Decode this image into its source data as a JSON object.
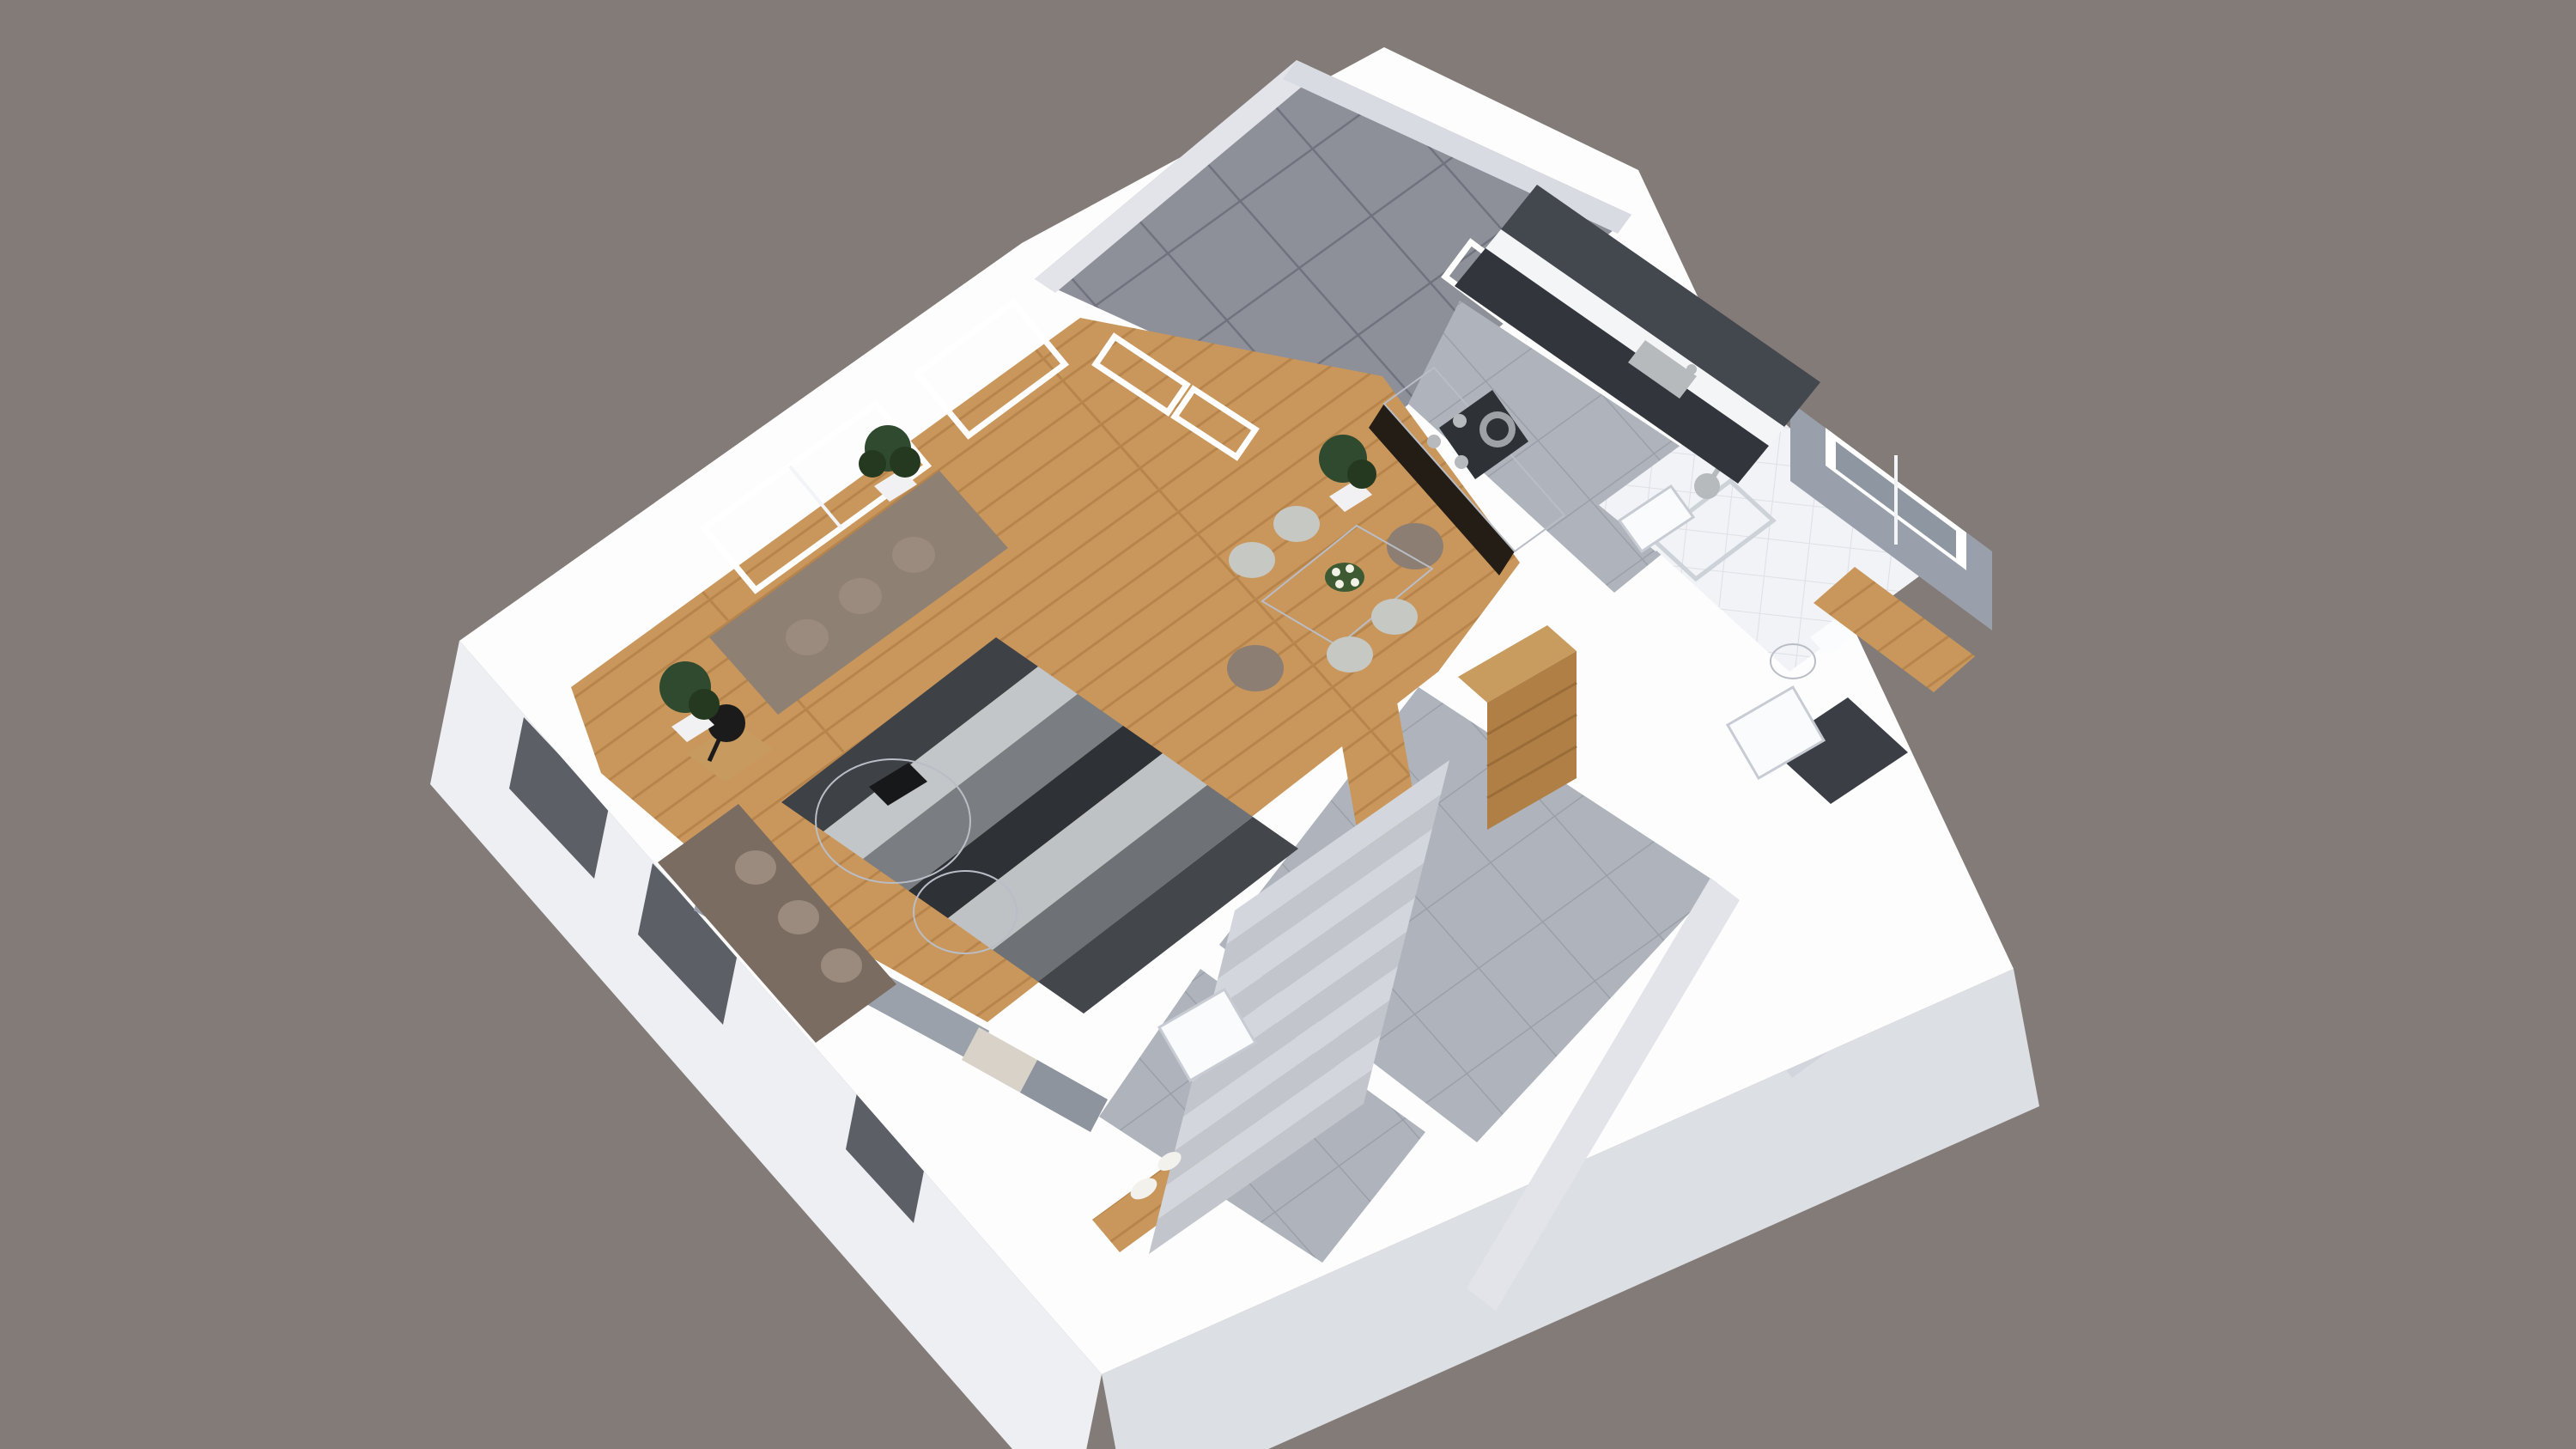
{
  "scene": {
    "title": "3D isometric cutaway floor plan render of an apartment",
    "view": "isometric-cutaway",
    "rooms": [
      {
        "id": "living-room",
        "floor": "wood",
        "furniture": [
          "sofa",
          "chaise-sofa",
          "striped-rug",
          "round-coffee-table-large",
          "round-coffee-table-small",
          "black-book",
          "wood-side-table",
          "black-desk-lamp",
          "potted-plant-window",
          "potted-plant-corner"
        ]
      },
      {
        "id": "dining-room",
        "floor": "wood",
        "furniture": [
          "white-dining-table",
          "flower-vase",
          "dining-chair-1",
          "dining-chair-2",
          "dining-chair-3",
          "dining-chair-4",
          "dining-armchair-1",
          "dining-armchair-2",
          "potted-plant"
        ]
      },
      {
        "id": "kitchen",
        "floor": "gray-tile",
        "furniture": [
          "marble-island",
          "gas-hob",
          "frying-pan",
          "upper-cabinets-dark",
          "marble-counter",
          "base-cabinets-dark",
          "steel-sink",
          "terrace-door"
        ]
      },
      {
        "id": "bathroom",
        "floor": "white-tile",
        "furniture": [
          "walk-in-shower",
          "shower-head",
          "toilet",
          "door"
        ]
      },
      {
        "id": "hallway",
        "floor": "gray-tile",
        "furniture": [
          "tall-wood-wardrobe",
          "staircase-10-steps",
          "utility-door",
          "entry-door",
          "white-shoes",
          "wood-threshold"
        ]
      },
      {
        "id": "terrace",
        "floor": "concrete-tiles",
        "furniture": []
      },
      {
        "id": "side-room",
        "floor": "wood-strip",
        "furniture": [
          "sliding-window"
        ]
      }
    ]
  },
  "colors": {
    "background": "#837B77",
    "wall": "#FDFDFE",
    "facade_sw": "#EDEFF3",
    "facade_se": "#DCDFE4",
    "facade_niche": "#D2D5DB",
    "window_dark": "#5C6066",
    "wood_floor": "#C9975C",
    "wood_line": "#B7854C",
    "tile_floor": "#AEB3BC",
    "tile_line": "#9BA0A8",
    "terrace_tile": "#8D8F99",
    "terrace_line": "#70737D",
    "terrace_parapet_nw": "#E2E4EA",
    "terrace_parapet_ne": "#D8DBE2",
    "bath_tile": "#F1F3F6",
    "bath_line": "#DDE0E6",
    "dark_tile": "#3B3F45",
    "glass": "#AEB6BD",
    "glass_dark": "#8E96A2",
    "frame": "#FFFFFF",
    "sofa": "#8F8074",
    "sofa_dark": "#7A6C60",
    "cushion": "#9A8B7E",
    "rug": [
      "#3E4146",
      "#C3C6C9",
      "#7A7E83",
      "#2E3135",
      "#BFC2C5",
      "#6E7277",
      "#43464B"
    ],
    "marble": "#F4F4F2",
    "marble_edge": "#DBDBD8",
    "side_table": "#C79A60",
    "lamp": "#1B1B1C",
    "plant": "#2F4A2E",
    "plant_dark": "#24391F",
    "planter": "#F1F1F3",
    "table_white": "#FCFCFC",
    "chair_light": "#C6C9C3",
    "chair_dark": "#8C7E72",
    "flowers_green": "#3E5A33",
    "flowers_white": "#F2F1E6",
    "island_base": "#241D15",
    "hob": "#2E3236",
    "pan": "#9EA2A6",
    "cabinet_upper": "#43474E",
    "cabinet_base": "#32363C",
    "counter": "#F4F5F7",
    "steel": "#B7BABD",
    "wardrobe_top": "#C89B5F",
    "wardrobe_front": "#B07F46",
    "stair_light": "#D3D6DC",
    "stair_dark": "#C2C5CC",
    "door": "#FAFBFD",
    "shoes": "#F2F1EC",
    "wall_face": "#E2E4E9",
    "partition_gray_face": "#9BA1AB",
    "partition_beige": "#D8D2C8",
    "partition_gray": "#8E949E",
    "gray_wall": "#99A0AC",
    "book": "#17181A",
    "toilet": "#FBFCFD",
    "shower_glass": "#CDD2D9"
  }
}
